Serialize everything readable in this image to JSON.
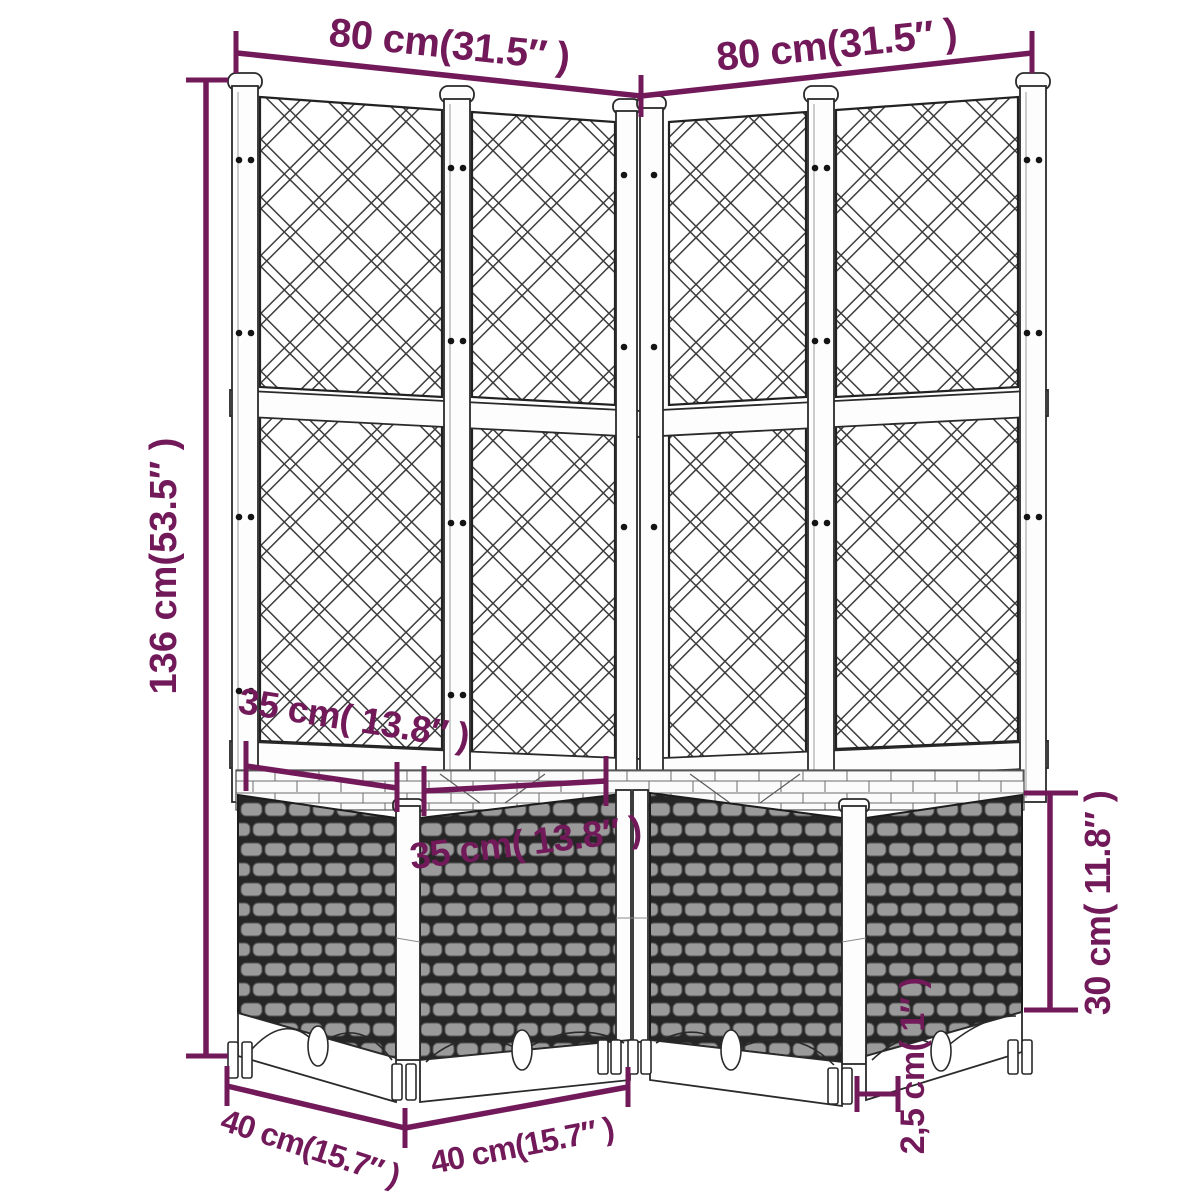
{
  "meta": {
    "title": "Garden planter with trellis — dimension diagram",
    "product": "Corner garden planter with lattice trellis and rattan-look boxes"
  },
  "colors": {
    "dimension": "#72195a",
    "ink": "#2a2a2a",
    "rattan_light": "#9a9a9a",
    "rattan_dark": "#262626",
    "background": "#ffffff"
  },
  "dimensions": {
    "top_width_left": "80 cm(31.5″ )",
    "top_width_right": "80 cm(31.5″ )",
    "overall_height": "136 cm(53.5″ )",
    "box_inner_left": "35 cm( 13.8″ )",
    "box_inner_front": "35 cm( 13.8″ )",
    "base_depth_left": "40 cm(15.7″ )",
    "base_width_front": "40 cm(15.7″ )",
    "planter_height": "30 cm( 11.8″ )",
    "foot_height": "2,5 cm( 1″ )"
  }
}
